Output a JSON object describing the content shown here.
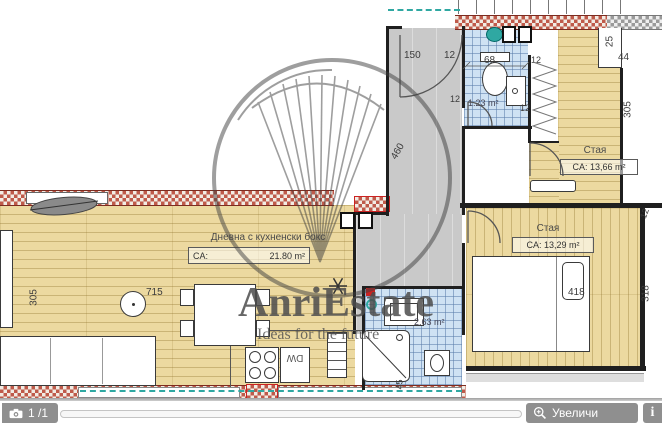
{
  "plan": {
    "rooms": {
      "living": {
        "name": "Дневна с кухненски бокс",
        "area_label": "CA:",
        "area_value": "21.80 m²"
      },
      "bedroom1": {
        "name": "Стая",
        "area": "CA: 13,66 m²"
      },
      "bedroom2": {
        "name": "Стая",
        "area": "CA: 13,29 m²"
      },
      "bath1": {
        "area": "1.23 m²"
      },
      "bath2": {
        "area": "2.63 m²"
      }
    },
    "dims": {
      "d150": "150",
      "d12a": "12",
      "d460": "460",
      "d68": "68",
      "d12b": "12",
      "d12c": "12",
      "d12d": "12",
      "d12e": "12",
      "d25": "25",
      "d44": "44",
      "d305r": "305",
      "d305l": "305",
      "d715": "715",
      "d418": "418",
      "d318": "318",
      "d45": "45"
    },
    "kitchen": {
      "dw": "DW"
    }
  },
  "watermark": {
    "brand": "AnriEstate",
    "tagline": "Ideas for the future"
  },
  "toolbar": {
    "page_indicator": "1 /1",
    "zoom_label": "Увеличи",
    "info_label": "i"
  },
  "colors": {
    "wood": "#ecd9a0",
    "tile": "#cfe2f3",
    "corridor": "#c9c9c9",
    "hatch_red": "#bf5a4a",
    "teal": "#2fa8a2",
    "wall": "#1f1f1f",
    "toolbar_gray": "#8f8f8f",
    "watermark_gray": "#4d4d4d"
  }
}
